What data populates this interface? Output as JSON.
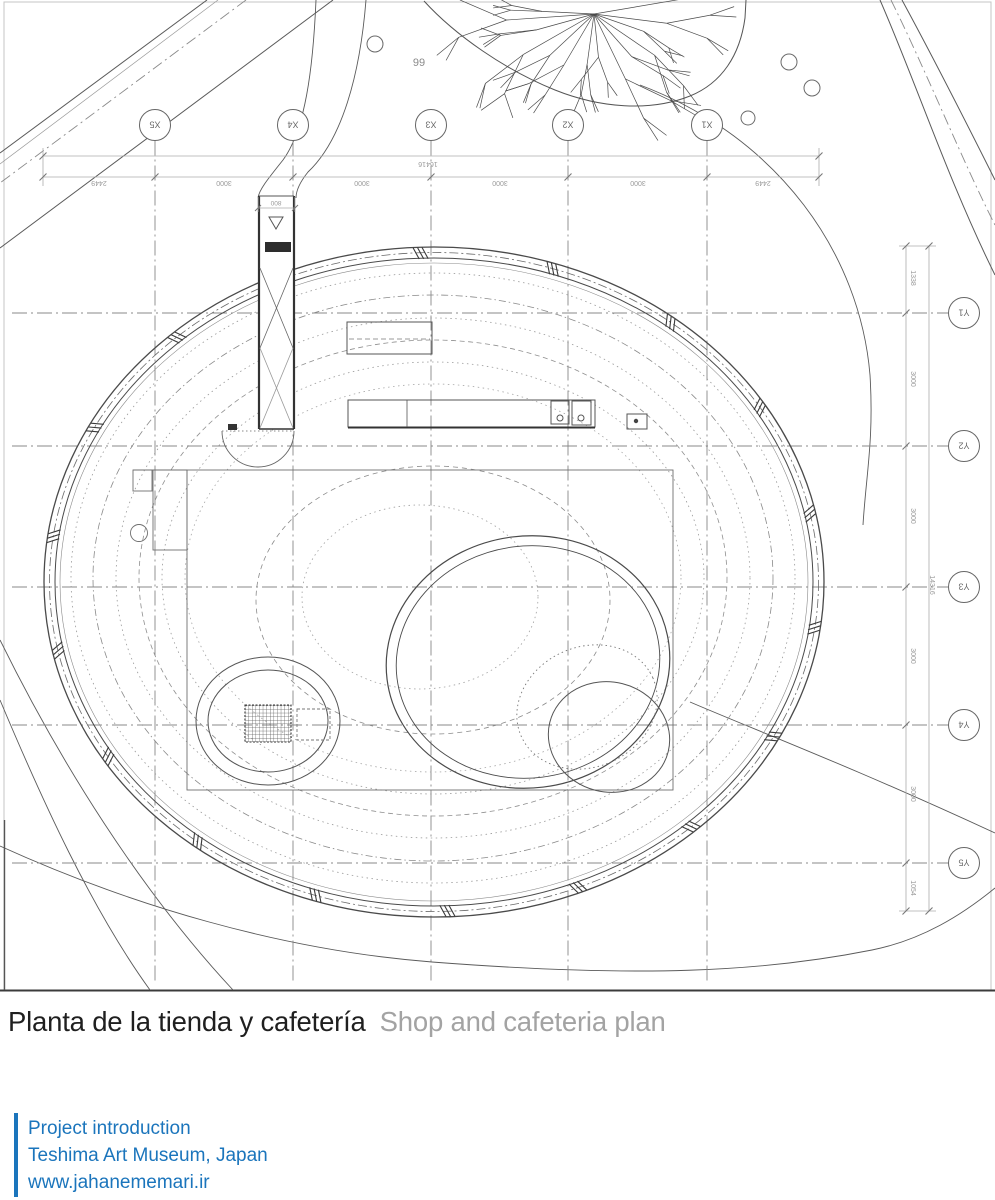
{
  "plan": {
    "grid_x_labels": [
      "X5",
      "X4",
      "X3",
      "X2",
      "X1"
    ],
    "grid_y_labels": [
      "Y1",
      "Y2",
      "Y3",
      "Y4",
      "Y5"
    ],
    "dims_top": {
      "total": "16416",
      "segments": [
        "2449",
        "3000",
        "3000",
        "3000",
        "3000",
        "2449"
      ],
      "corridor_width": "800"
    },
    "dims_right": {
      "total": "14316",
      "segments": [
        "1338",
        "3000",
        "3000",
        "3000",
        "3000",
        "1054"
      ]
    },
    "site_note": "99"
  },
  "caption": {
    "title_spanish": "Planta de la tienda y cafetería",
    "title_english": "Shop and cafeteria plan"
  },
  "footer": {
    "line1": "Project introduction",
    "line2": "Teshima Art Museum, Japan",
    "line3": "www.jahanememari.ir"
  },
  "colors": {
    "accent_blue": "#1b75bc",
    "title_black": "#1f1f1f",
    "title_gray": "#a3a3a3",
    "drawing_line": "#4a4a4a",
    "contour_line": "#999999"
  }
}
